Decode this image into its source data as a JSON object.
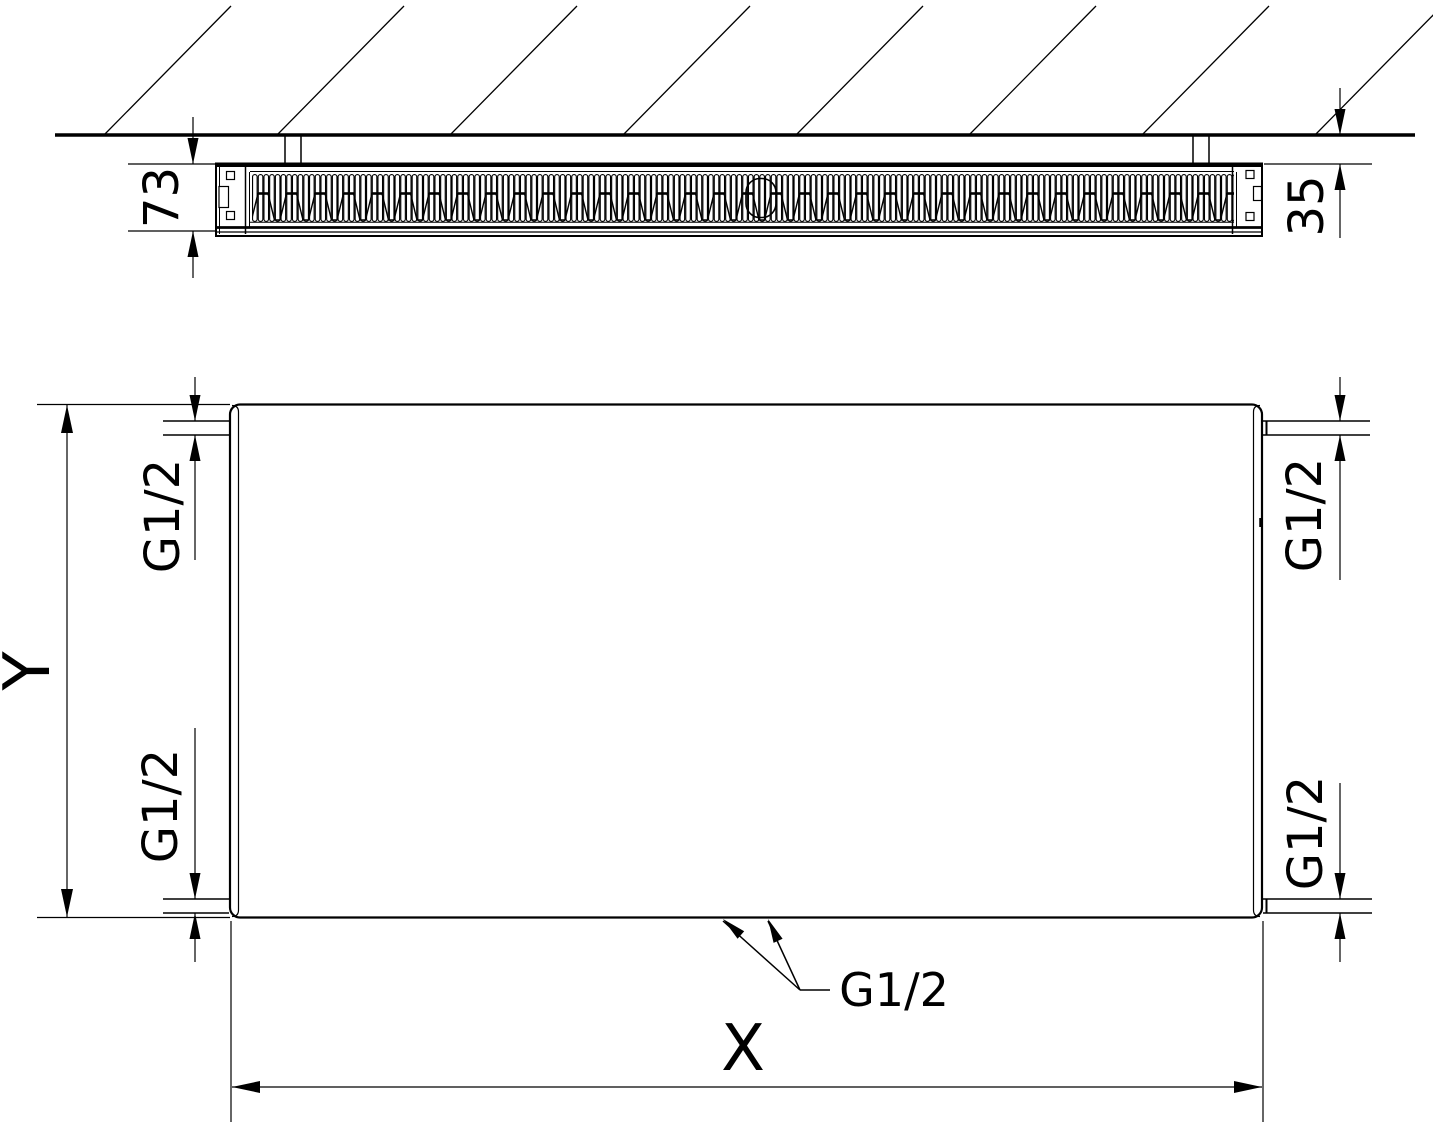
{
  "top_view": {
    "depth_dimension": "73",
    "wall_clearance_dimension": "35"
  },
  "front_view": {
    "width_dimension": "X",
    "height_dimension": "Y",
    "connections": {
      "top_left": "G1/2",
      "top_right": "G1/2",
      "bottom_left": "G1/2",
      "bottom_right": "G1/2",
      "bottom_center": "G1/2"
    }
  },
  "colors": {
    "line": "#000000",
    "background": "#ffffff"
  }
}
